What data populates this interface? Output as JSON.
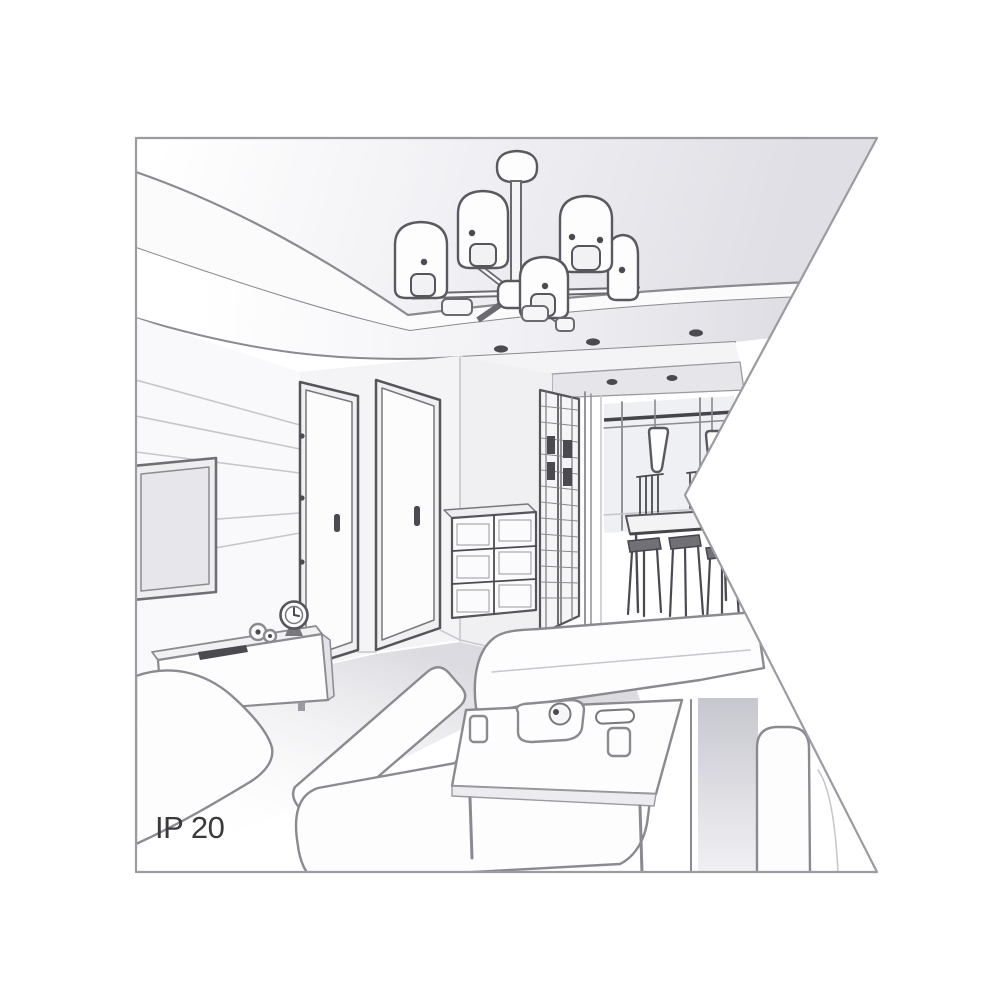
{
  "figure": {
    "type": "product-illustration",
    "label": "IP 20",
    "scene": "black-and-white perspective line-art sketch of a living room interior, right edge of the picture notched in a flag / arrow shape",
    "objects": [
      "six-arm ceiling chandelier with cylindrical shades on a suspended ceiling panel",
      "recessed ceiling downlights",
      "wall-mounted tv on slatted wall",
      "sideboard with clock, figurine and remote control",
      "two interior doors",
      "drawer chest with six panels",
      "tall glass-grid wardrobe",
      "hallway with window and two cone pendant lights",
      "dining table with chairs",
      "white sectional sofas",
      "coffee table with cups, bowl and tray"
    ]
  },
  "colors": {
    "page_bg": "#ffffff",
    "line": "#8a8a90",
    "line_soft": "#c6c6cc",
    "line_dark": "#4a4a50",
    "frame_border": "#9b9ba1",
    "white_fill": "#fdfdfe",
    "panel_gray": "#e2e2e7",
    "strip_gray": "#e6e6ea",
    "floor_gray": "#dcdce2",
    "text_color": "#3a3a3c"
  }
}
